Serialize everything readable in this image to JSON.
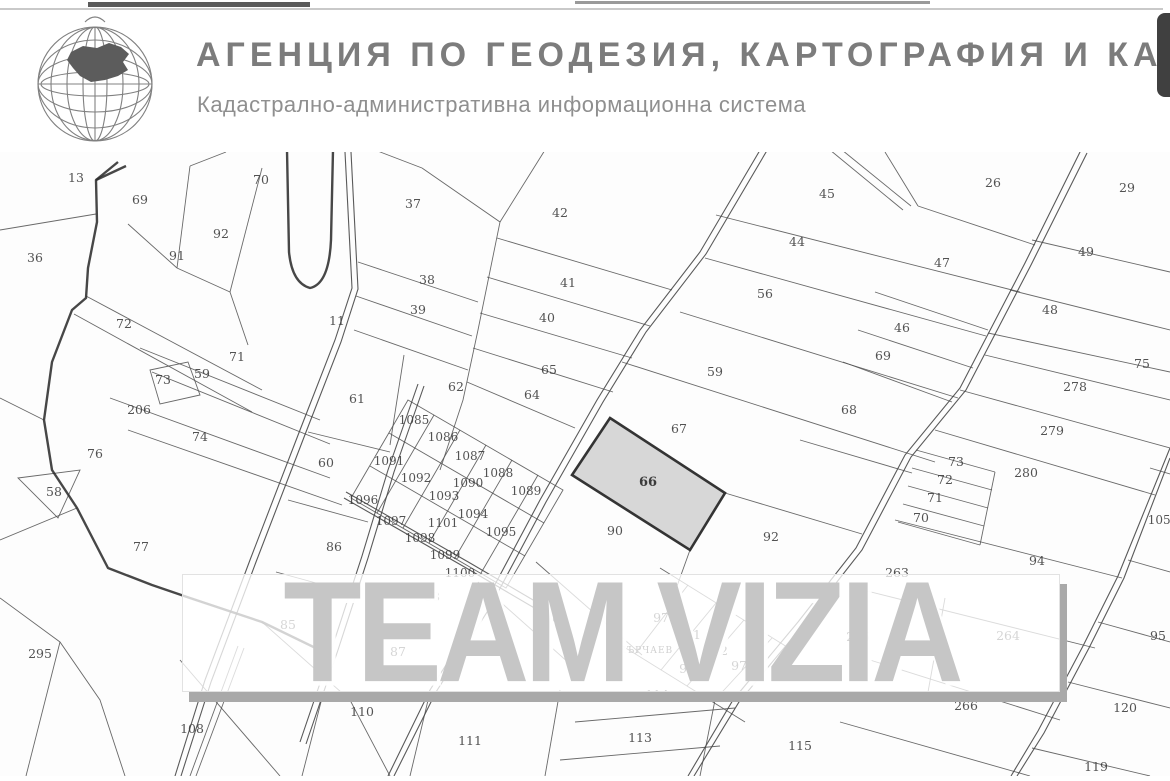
{
  "header": {
    "title": "АГЕНЦИЯ ПО ГЕОДЕЗИЯ, КАРТОГРАФИЯ И КАДА",
    "subtitle": "Кадастрално-административна информационна система",
    "logo": "globe-bulgaria-logo"
  },
  "side_tab": "scroll-tab",
  "watermark_text": "TEAM VIZIA",
  "colors": {
    "thin_line": "#4f4f4f",
    "road_line": "#474747",
    "thick_line": "#2e2e2e",
    "highlight_fill": "#d6d6d6",
    "highlight_stroke": "#2a2a2a",
    "label": "#3b3b3b",
    "tab": "#404040"
  },
  "map": {
    "village_label": {
      "t": "МЪРЧАЕВ",
      "x": 645,
      "y": 653
    },
    "highlighted_parcel": {
      "number": "66",
      "points": "610,418 725,493 690,550 572,475",
      "x": 648,
      "y": 486
    },
    "labels": [
      {
        "t": "13",
        "x": 76,
        "y": 182
      },
      {
        "t": "69",
        "x": 140,
        "y": 204
      },
      {
        "t": "70",
        "x": 261,
        "y": 184
      },
      {
        "t": "92",
        "x": 221,
        "y": 238
      },
      {
        "t": "91",
        "x": 177,
        "y": 260
      },
      {
        "t": "36",
        "x": 35,
        "y": 262
      },
      {
        "t": "72",
        "x": 124,
        "y": 328
      },
      {
        "t": "71",
        "x": 237,
        "y": 361
      },
      {
        "t": "73",
        "x": 163,
        "y": 384
      },
      {
        "t": "59",
        "x": 202,
        "y": 378
      },
      {
        "t": "206",
        "x": 139,
        "y": 414
      },
      {
        "t": "74",
        "x": 200,
        "y": 441
      },
      {
        "t": "76",
        "x": 95,
        "y": 458
      },
      {
        "t": "58",
        "x": 54,
        "y": 496
      },
      {
        "t": "77",
        "x": 141,
        "y": 551
      },
      {
        "t": "295",
        "x": 40,
        "y": 658
      },
      {
        "t": "11",
        "x": 337,
        "y": 325
      },
      {
        "t": "37",
        "x": 413,
        "y": 208
      },
      {
        "t": "42",
        "x": 560,
        "y": 217
      },
      {
        "t": "38",
        "x": 427,
        "y": 284
      },
      {
        "t": "41",
        "x": 568,
        "y": 287
      },
      {
        "t": "39",
        "x": 418,
        "y": 314
      },
      {
        "t": "40",
        "x": 547,
        "y": 322
      },
      {
        "t": "65",
        "x": 549,
        "y": 374
      },
      {
        "t": "64",
        "x": 532,
        "y": 399
      },
      {
        "t": "62",
        "x": 456,
        "y": 391
      },
      {
        "t": "61",
        "x": 357,
        "y": 403
      },
      {
        "t": "60",
        "x": 326,
        "y": 467
      },
      {
        "t": "86",
        "x": 334,
        "y": 551
      },
      {
        "t": "85",
        "x": 288,
        "y": 629
      },
      {
        "t": "87",
        "x": 398,
        "y": 656
      },
      {
        "t": "88",
        "x": 432,
        "y": 601
      },
      {
        "t": "89",
        "x": 560,
        "y": 622
      },
      {
        "t": "90",
        "x": 615,
        "y": 535
      },
      {
        "t": "1085",
        "x": 414,
        "y": 424
      },
      {
        "t": "1086",
        "x": 443,
        "y": 441
      },
      {
        "t": "1087",
        "x": 470,
        "y": 460
      },
      {
        "t": "1088",
        "x": 498,
        "y": 477
      },
      {
        "t": "1089",
        "x": 526,
        "y": 495
      },
      {
        "t": "1090",
        "x": 468,
        "y": 487
      },
      {
        "t": "1091",
        "x": 389,
        "y": 465
      },
      {
        "t": "1092",
        "x": 416,
        "y": 482
      },
      {
        "t": "1093",
        "x": 444,
        "y": 500
      },
      {
        "t": "1094",
        "x": 473,
        "y": 518
      },
      {
        "t": "1095",
        "x": 501,
        "y": 536
      },
      {
        "t": "1096",
        "x": 363,
        "y": 504
      },
      {
        "t": "1097",
        "x": 391,
        "y": 525
      },
      {
        "t": "1098",
        "x": 420,
        "y": 542
      },
      {
        "t": "1099",
        "x": 445,
        "y": 559
      },
      {
        "t": "1100",
        "x": 460,
        "y": 577
      },
      {
        "t": "1101",
        "x": 443,
        "y": 527
      },
      {
        "t": "45",
        "x": 827,
        "y": 198
      },
      {
        "t": "44",
        "x": 797,
        "y": 246
      },
      {
        "t": "56",
        "x": 765,
        "y": 298
      },
      {
        "t": "26",
        "x": 993,
        "y": 187
      },
      {
        "t": "29",
        "x": 1127,
        "y": 192
      },
      {
        "t": "47",
        "x": 942,
        "y": 267
      },
      {
        "t": "49",
        "x": 1086,
        "y": 256
      },
      {
        "t": "48",
        "x": 1050,
        "y": 314
      },
      {
        "t": "46",
        "x": 902,
        "y": 332
      },
      {
        "t": "69",
        "x": 883,
        "y": 360
      },
      {
        "t": "68",
        "x": 849,
        "y": 414
      },
      {
        "t": "59",
        "x": 715,
        "y": 376
      },
      {
        "t": "67",
        "x": 679,
        "y": 433
      },
      {
        "t": "92",
        "x": 771,
        "y": 541
      },
      {
        "t": "75",
        "x": 1142,
        "y": 368
      },
      {
        "t": "278",
        "x": 1075,
        "y": 391
      },
      {
        "t": "279",
        "x": 1052,
        "y": 435
      },
      {
        "t": "280",
        "x": 1026,
        "y": 477
      },
      {
        "t": "73",
        "x": 956,
        "y": 466
      },
      {
        "t": "72",
        "x": 945,
        "y": 484
      },
      {
        "t": "71",
        "x": 935,
        "y": 502
      },
      {
        "t": "70",
        "x": 921,
        "y": 522
      },
      {
        "t": "94",
        "x": 1037,
        "y": 565
      },
      {
        "t": "263",
        "x": 897,
        "y": 577
      },
      {
        "t": "265",
        "x": 858,
        "y": 641
      },
      {
        "t": "264",
        "x": 1008,
        "y": 640
      },
      {
        "t": "266",
        "x": 966,
        "y": 710
      },
      {
        "t": "120",
        "x": 1125,
        "y": 712
      },
      {
        "t": "115",
        "x": 800,
        "y": 750
      },
      {
        "t": "113",
        "x": 640,
        "y": 742
      },
      {
        "t": "114",
        "x": 657,
        "y": 699
      },
      {
        "t": "110",
        "x": 362,
        "y": 716
      },
      {
        "t": "108",
        "x": 192,
        "y": 733
      },
      {
        "t": "111",
        "x": 470,
        "y": 745
      },
      {
        "t": "970",
        "x": 665,
        "y": 622
      },
      {
        "t": "971",
        "x": 689,
        "y": 639
      },
      {
        "t": "972",
        "x": 716,
        "y": 655
      },
      {
        "t": "973",
        "x": 743,
        "y": 670
      },
      {
        "t": "974",
        "x": 691,
        "y": 673
      },
      {
        "t": "1054",
        "x": 1163,
        "y": 524
      },
      {
        "t": "95",
        "x": 1158,
        "y": 640
      },
      {
        "t": "119",
        "x": 1096,
        "y": 771
      }
    ],
    "thin_lines": [
      "M0,230 L96,214",
      "M190,166 L177,268",
      "M262,168 L230,292",
      "M128,224 L177,268",
      "M177,268 L230,292",
      "M230,292 L248,345",
      "M226,152 L190,166",
      "M86,296 L262,390",
      "M74,314 L252,412",
      "M140,348 L320,420",
      "M152,372 L330,444",
      "M150,370 L188,362 L200,395 L160,404 Z",
      "M110,398 L330,478",
      "M128,430 L342,505",
      "M18,478 L80,470 L58,518 Z",
      "M0,398 L44,420",
      "M0,540 L77,508",
      "M0,598 L60,642 L100,700 L125,776",
      "M60,642 L26,776",
      "M262,622 L350,700 L390,776",
      "M180,660 L280,776",
      "M238,646 L190,776",
      "M244,648 L196,776",
      "M322,698 L302,776",
      "M430,692 L410,776",
      "M560,690 L545,776",
      "M422,168 L500,222 L478,330 L463,400 L440,470",
      "M375,150 L422,168",
      "M545,150 L500,222",
      "M358,262 L478,302",
      "M356,296 L472,336",
      "M354,330 L468,370",
      "M404,355 L390,445",
      "M308,432 L390,452",
      "M288,500 L368,522",
      "M276,572 L356,594",
      "M497,238 L672,290",
      "M487,277 L650,326",
      "M480,313 L632,358",
      "M473,348 L613,392",
      "M467,382 L575,428",
      "M408,400 L563,490 L506,588 L351,498 Z",
      "M389,433 L544,523",
      "M370,466 L525,556",
      "M434,415 L377,513",
      "M460,430 L403,528",
      "M486,445 L429,543",
      "M512,460 L455,558",
      "M538,475 L481,573",
      "M478,582 L588,680",
      "M536,562 L642,655",
      "M716,215 L1020,292",
      "M705,258 L986,336",
      "M680,312 L958,398",
      "M622,362 L935,462",
      "M725,493 L862,534",
      "M690,550 L672,600",
      "M918,206 L1035,245",
      "M885,152 L918,206",
      "M875,292 L988,330",
      "M858,330 L973,368",
      "M843,362 L952,402",
      "M800,440 L912,473",
      "M1032,240 L1170,272",
      "M1010,290 L1170,330",
      "M988,333 L1170,372",
      "M985,355 L1170,400",
      "M960,390 L1170,448",
      "M935,430 L1155,495",
      "M916,450 L995,472",
      "M912,468 L992,490",
      "M908,486 L988,508",
      "M903,504 L984,526",
      "M898,522 L980,545",
      "M995,472 L980,545",
      "M895,520 L1122,578",
      "M855,588 L1095,648",
      "M945,598 L928,692",
      "M870,660 L1060,720",
      "M840,722 L1030,776",
      "M1150,468 L1170,474",
      "M1128,560 L1170,572",
      "M1098,622 L1170,642",
      "M1068,682 L1170,708",
      "M1032,748 L1150,776",
      "M660,568 L800,655",
      "M616,642 L745,722",
      "M635,654 L688,585",
      "M661,670 L716,603",
      "M687,686 L744,620",
      "M713,702 L772,638",
      "M575,722 L735,708",
      "M560,760 L720,746",
      "M715,700 L700,776",
      "M830,150 L903,210",
      "M842,150 L911,206"
    ],
    "roads": [
      "M766,140 L700,252 L640,330 L597,400 L540,500 L483,607 L430,690 L388,776",
      "M772,142 L706,254 L646,332 L603,402 L546,502 L489,609 L436,692 L394,776",
      "M1081,150 L1025,263 L960,388 L905,455 L856,548 L798,622 L733,700 L688,776",
      "M1087,153 L1031,265 L966,390 L911,457 L862,550 L804,624 L739,702 L694,776",
      "M1170,448 L1118,576 L1083,646 L1038,731 L1011,776",
      "M1170,458 L1124,578 L1089,648 L1044,733 L1017,776",
      "M345,152 L352,288 L335,340 L300,430 L250,560 L205,680 L175,776",
      "M351,152 L358,289 L341,342 L306,432 L256,562 L211,682 L181,776",
      "M418,384 L388,470 L362,556 L332,648 L300,742",
      "M424,386 L394,472 L368,558 L338,650 L306,744",
      "M346,492 L470,563 L545,607",
      "M344,498 L468,569 L543,613"
    ],
    "thick_lines": [
      "M118,162 L96,180 L97,222 L88,268 L86,298 L72,310 L52,362 L44,420 L52,470 L77,508 L108,568 L152,585 L190,598 L232,612 L262,622 L330,655",
      "M96,180 L126,166",
      "M287,150 L289,252 Q292,283 310,288 Q329,284 331,240 L333,150"
    ]
  }
}
